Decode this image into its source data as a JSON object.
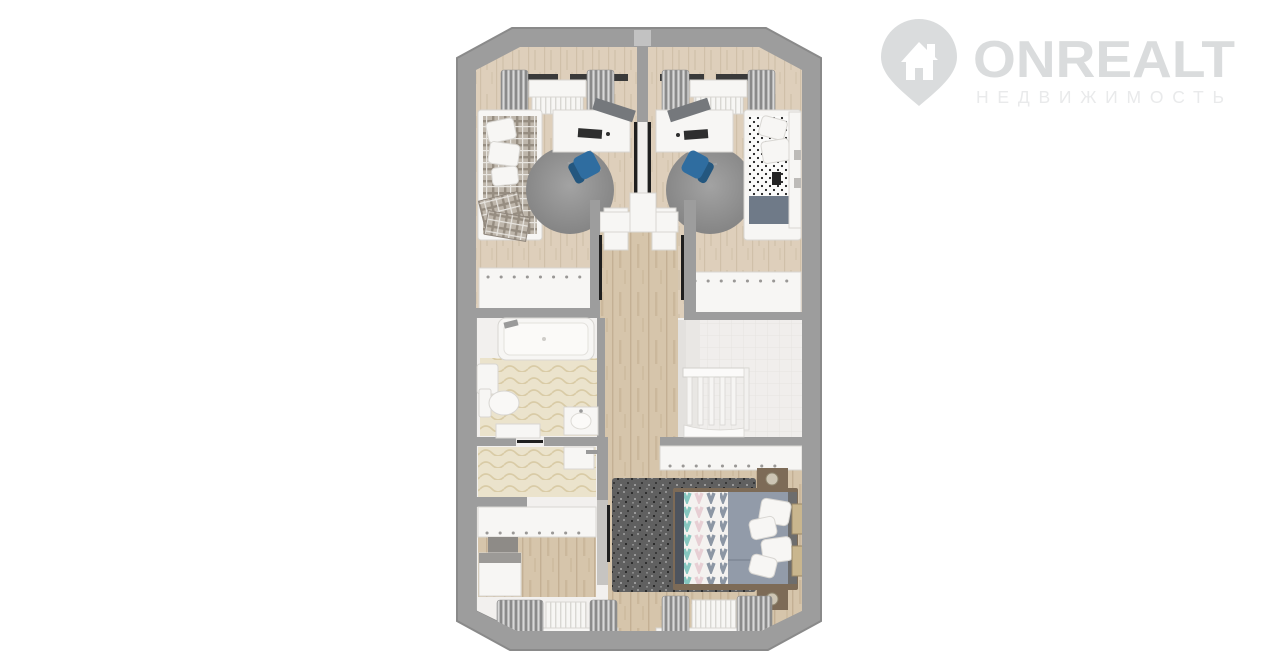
{
  "watermark": {
    "brand": "ONREALT",
    "subtitle": "НЕДВИЖИМОСТЬ",
    "icon": "house-location-pin-icon"
  },
  "scene": {
    "type": "3d-floor-plan-top-down-render",
    "background": "#ffffff",
    "palette": {
      "wall": "#9d9d9d",
      "wallsoft": "#c6c4c1",
      "white": "#f2f0ee",
      "whitebox": "#f7f6f4",
      "blue": "#2f6da0",
      "blued": "#24577f",
      "duvet": "#929ba9",
      "duvdark": "#4e545e",
      "brown": "#7d6b57",
      "frame": "#1f1f1f",
      "glazing": "#3a3a3a",
      "lamp": "#cdc5b4",
      "art": "#c9b68e",
      "logo": "#dadcdd",
      "logosub": "#e9eaeb",
      "wood": "#d6c5ab",
      "woodlight": "#decfbb",
      "tilefloor": "#ebe3cc",
      "ruggray": "#8f8f8f",
      "rugdark": "#5f5f5f",
      "chevteal": "#86c7c0",
      "chevpink": "#e7cfd4",
      "chevgray": "#8c96a4"
    },
    "rooms": [
      {
        "id": "bedroom-top-left",
        "furniture": [
          "single-bed-plaid",
          "desk",
          "office-chair-blue",
          "round-rug",
          "window-curtains",
          "radiator",
          "wardrobe"
        ]
      },
      {
        "id": "bedroom-top-right",
        "furniture": [
          "single-bed-polka-dot",
          "desk",
          "office-chair-blue",
          "round-rug",
          "window-curtains",
          "radiator",
          "wardrobe"
        ]
      },
      {
        "id": "bathroom",
        "furniture": [
          "bathtub",
          "toilet",
          "sink",
          "boiler"
        ]
      },
      {
        "id": "hallway",
        "furniture": [
          "wood-floor"
        ]
      },
      {
        "id": "staircase",
        "furniture": [
          "railing",
          "steps"
        ]
      },
      {
        "id": "dressing-room",
        "furniture": [
          "sink-small",
          "wardrobe",
          "dresser",
          "cabinet",
          "window-curtains",
          "radiator"
        ]
      },
      {
        "id": "master-bedroom",
        "furniture": [
          "double-bed-chevron",
          "pillows",
          "nightstands",
          "lamps",
          "dark-rug",
          "wardrobe",
          "window-curtains",
          "radiator",
          "wall-art"
        ]
      }
    ]
  }
}
